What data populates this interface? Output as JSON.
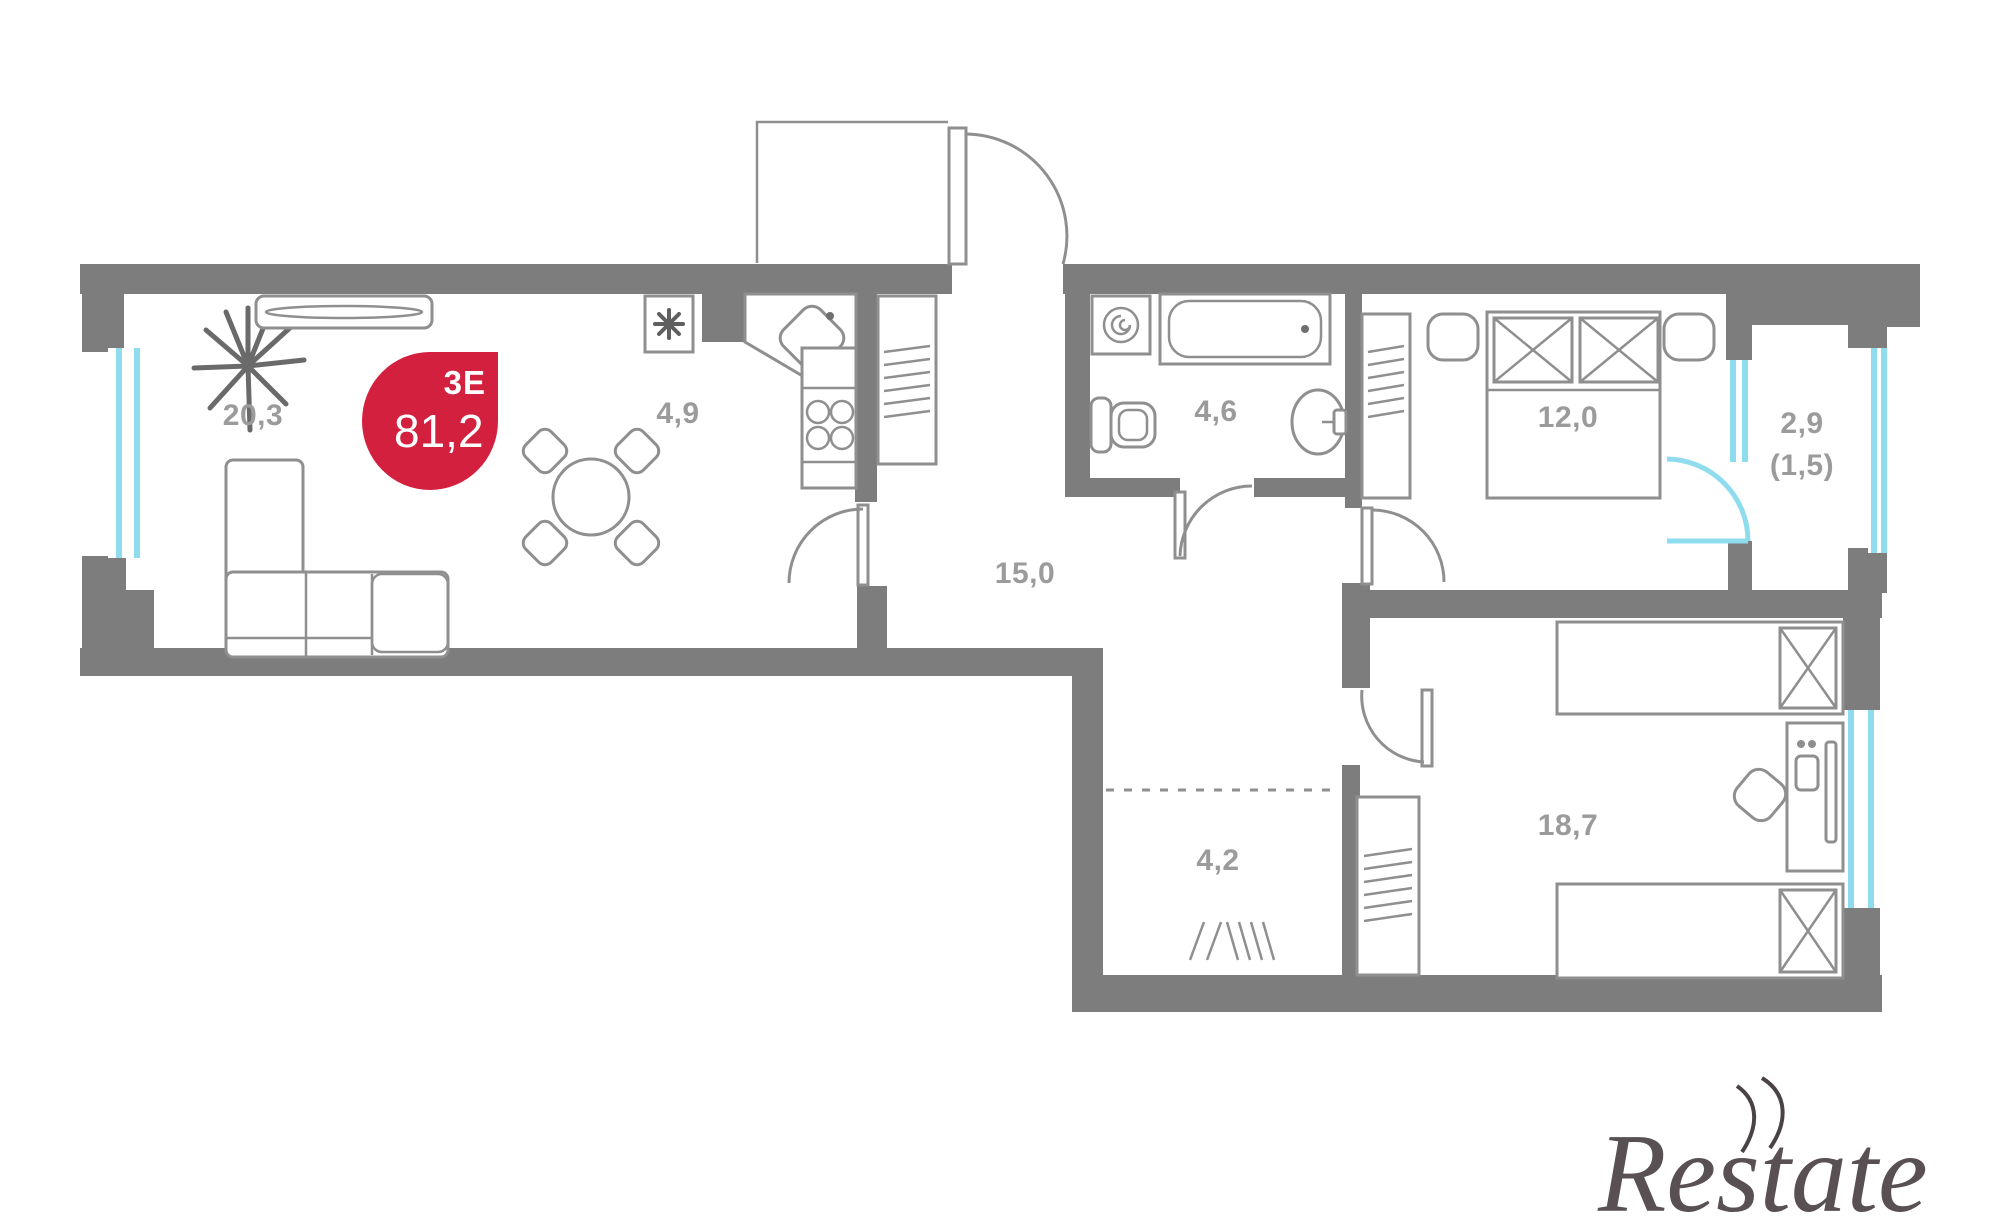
{
  "plan": {
    "type_label": "3E",
    "total_area": "81,2",
    "rooms": [
      {
        "id": "living-room",
        "area": "20,3"
      },
      {
        "id": "kitchen",
        "area": "4,9"
      },
      {
        "id": "hallway",
        "area": "15,0"
      },
      {
        "id": "bathroom",
        "area": "4,6"
      },
      {
        "id": "bedroom-1",
        "area": "12,0"
      },
      {
        "id": "balcony",
        "area": "2,9",
        "area_reduced": "(1,5)"
      },
      {
        "id": "dressing-area",
        "area": "4,2"
      },
      {
        "id": "bedroom-2",
        "area": "18,7"
      }
    ]
  },
  "watermark": {
    "text": "Restate"
  },
  "colors": {
    "wall": "#7d7d7d",
    "furniture": "#8f8f8f",
    "window": "#8edcee",
    "accent": "#d2203e",
    "label": "#9b9b9b",
    "watermark": "#4a4244",
    "background": "#ffffff"
  }
}
